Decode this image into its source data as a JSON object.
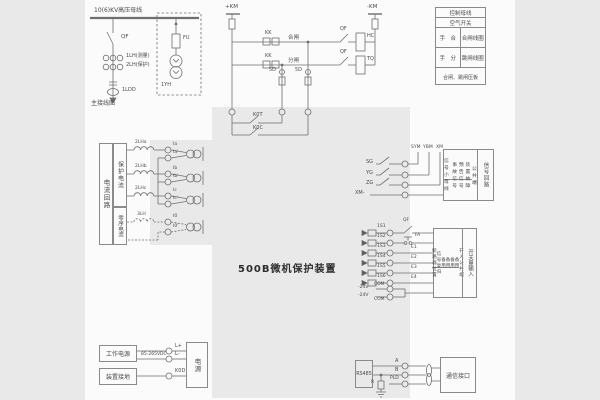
{
  "title": "500B微机保护装置",
  "main": {
    "bus": "10(6)KV高压母线",
    "qf": "QF",
    "ct1": "1LH(测量)",
    "ct2": "2LH(保护)",
    "ct0": "1LDD",
    "caption": "主接线图",
    "fu": "FU",
    "pt": "1YH"
  },
  "ctl": {
    "pos": "+KM",
    "neg": "-KM",
    "kk": "KK",
    "close": "合闸",
    "trip": "分闸",
    "qf": "QF",
    "hc": "HC",
    "tq": "TQ",
    "fuse": "5D",
    "k0t": "K0T",
    "k0c": "K0C",
    "table": {
      "r1": "控制母线",
      "r2": "空气开关",
      "r3l": "手　合",
      "r3r": "合闸线圈",
      "r4l": "手　分",
      "r4r": "跳闸线圈",
      "r5": "合闸、跳闸压板"
    }
  },
  "cur": {
    "col1": "电流回路",
    "col2": "保护电流",
    "col3": "零序电流",
    "cta": "2LHa",
    "ctb": "2LHb",
    "ctc": "2LHc",
    "ct0": "3LH",
    "ia": "Ia",
    "ian": "Ia'",
    "ib": "Ib",
    "ibn": "Ib'",
    "ic": "Ic",
    "icn": "Ic'",
    "i0": "I0",
    "i0n": "I0'"
  },
  "sig": {
    "bus1": "SYM",
    "bus2": "YBM",
    "bus3": "XM",
    "c1": "SG",
    "c2": "YG",
    "c3": "ZG",
    "c4": "XM-",
    "rows": [
      "信号小母线",
      "事故信号",
      "预告信号",
      "装置故障",
      "公共端"
    ],
    "side": "信号回路"
  },
  "di": {
    "in": [
      "1S1",
      "1S2",
      "1S3",
      "1S4",
      "1S5",
      "1S6"
    ],
    "qf": "QF",
    "fa": "FA",
    "e": [
      "E1",
      "E2",
      "E3",
      "E4"
    ],
    "n24": "-24V",
    "com": "COM",
    "rows": [
      "断路器位置",
      "信号复归",
      "备用",
      "备用",
      "备用",
      "备用",
      "开入公共端"
    ],
    "side": "开关量输入"
  },
  "pwr": {
    "b1": "工作电源",
    "b2": "装置接地",
    "range": "85-265VDC",
    "t1": "L+",
    "t2": "L-",
    "t3": "K0D",
    "module": "电源"
  },
  "com": {
    "dev": "RS485",
    "a": "A",
    "b": "B",
    "shield": "PLD",
    "r": "R",
    "box": "通信接口"
  }
}
